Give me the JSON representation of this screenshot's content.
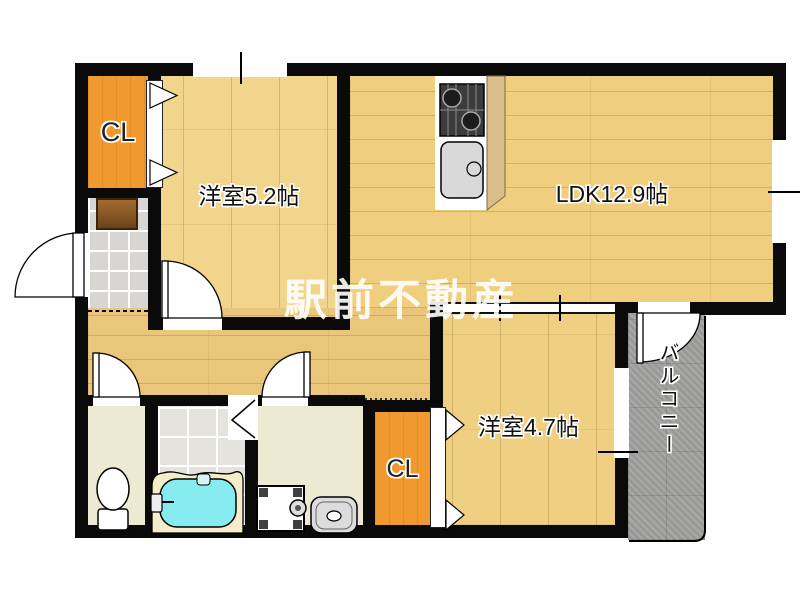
{
  "title": "間取り図",
  "rooms": {
    "closet_top": "CL",
    "bedroom_52": "洋室5.2帖",
    "ldk": "LDK12.9帖",
    "bedroom_47": "洋室4.7帖",
    "closet_bottom": "CL",
    "balcony": "バルコニー"
  },
  "watermark": "駅前不動産",
  "icons": {
    "stove": "stove-icon",
    "kitchen_sink": "kitchen-sink-icon",
    "toilet": "toilet-icon",
    "bathtub": "bathtub-icon",
    "washing_machine": "washing-machine-icon",
    "washbasin": "washbasin-icon",
    "entrance_mat": "entrance-mat",
    "door_swing": "door-swing-arc",
    "folding_door": "folding-door-zigzag",
    "closet_doors": "folding-door-arrow",
    "window": "window-marker"
  },
  "colors": {
    "wall": "#0a0a0a",
    "wood_bedroom52": "#F1D58C",
    "wood_ldk": "#EFCE7D",
    "wood_hall": "#E9C67A",
    "wood_bedroom47": "#EFD083",
    "closet_orange": "#F0992F",
    "bathtub_cyan": "#87ECEF",
    "bathtub_rim": "#F4EDC9",
    "balcony_gray": "#A1A19F",
    "genkan_tile": "#D8D6D2",
    "bath_tile": "#E5E3DE",
    "beige_floor": "#EDEAD3",
    "mat_brown": "#8F5B26",
    "watermark_white": "#FFFFFF"
  }
}
